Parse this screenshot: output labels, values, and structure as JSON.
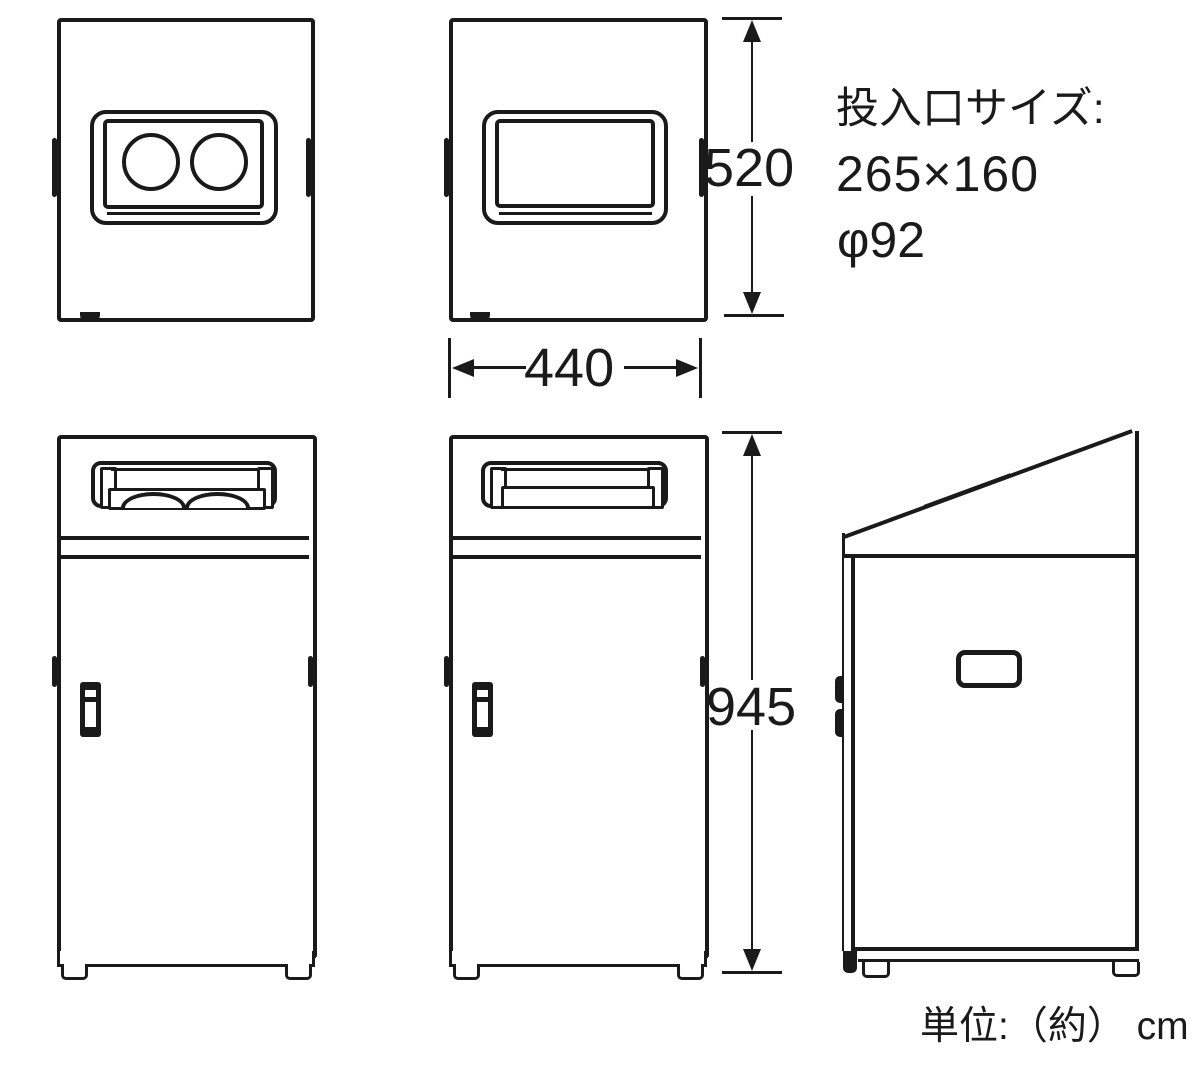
{
  "document": {
    "type": "product-dimension-diagram",
    "subject": "recycle-bin-line-drawing"
  },
  "annotations": {
    "inlet_size_label": "投入口サイズ:",
    "inlet_rect_size": "265×160",
    "inlet_hole_diameter": "φ92",
    "unit_note": "単位:（約） cm"
  },
  "dimensions": {
    "top_section_height": "520",
    "width": "440",
    "body_height": "945"
  },
  "colors": {
    "ink": "#1a1a1a",
    "background": "#ffffff"
  }
}
